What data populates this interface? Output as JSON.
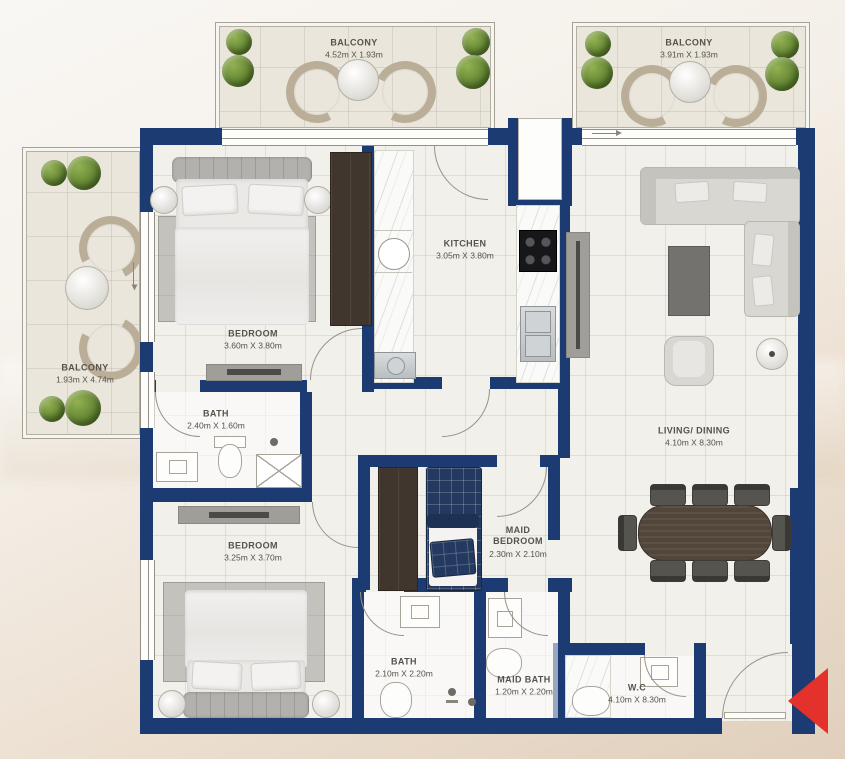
{
  "floor_plan": {
    "title": "2 Bedroom + Maid Apartment Floor Plan",
    "colors": {
      "wall": "#1c3b72",
      "floor": "#f2f0ea",
      "balcony_floor": "#eae6db",
      "marble": "#fafaf8",
      "wood_dark": "#41362d",
      "maid_bed_navy": "#24395f",
      "entrance_arrow": "#e5312b"
    },
    "rooms": {
      "balcony_top_left": {
        "name": "BALCONY",
        "dims": "4.52m X 1.93m"
      },
      "balcony_top_right": {
        "name": "BALCONY",
        "dims": "3.91m X 1.93m"
      },
      "balcony_left": {
        "name": "BALCONY",
        "dims": "1.93m X 4.74m"
      },
      "bedroom_1": {
        "name": "BEDROOM",
        "dims": "3.60m X 3.80m"
      },
      "kitchen": {
        "name": "KITCHEN",
        "dims": "3.05m X 3.80m"
      },
      "living_dining": {
        "name": "LIVING/ DINING",
        "dims": "4.10m X 8.30m"
      },
      "bath_1": {
        "name": "BATH",
        "dims": "2.40m X 1.60m"
      },
      "bedroom_2": {
        "name": "BEDROOM",
        "dims": "3.25m X 3.70m"
      },
      "maid_bedroom": {
        "name": "MAID BEDROOM",
        "dims": "2.30m X 2.10m"
      },
      "bath_2": {
        "name": "BATH",
        "dims": "2.10m X 2.20m"
      },
      "maid_bath": {
        "name": "MAID BATH",
        "dims": "1.20m X 2.20m"
      },
      "wc": {
        "name": "W.C",
        "dims": "4.10m X 8.30m"
      }
    },
    "entrance": {
      "marker": "entrance-arrow",
      "direction": "left"
    }
  }
}
